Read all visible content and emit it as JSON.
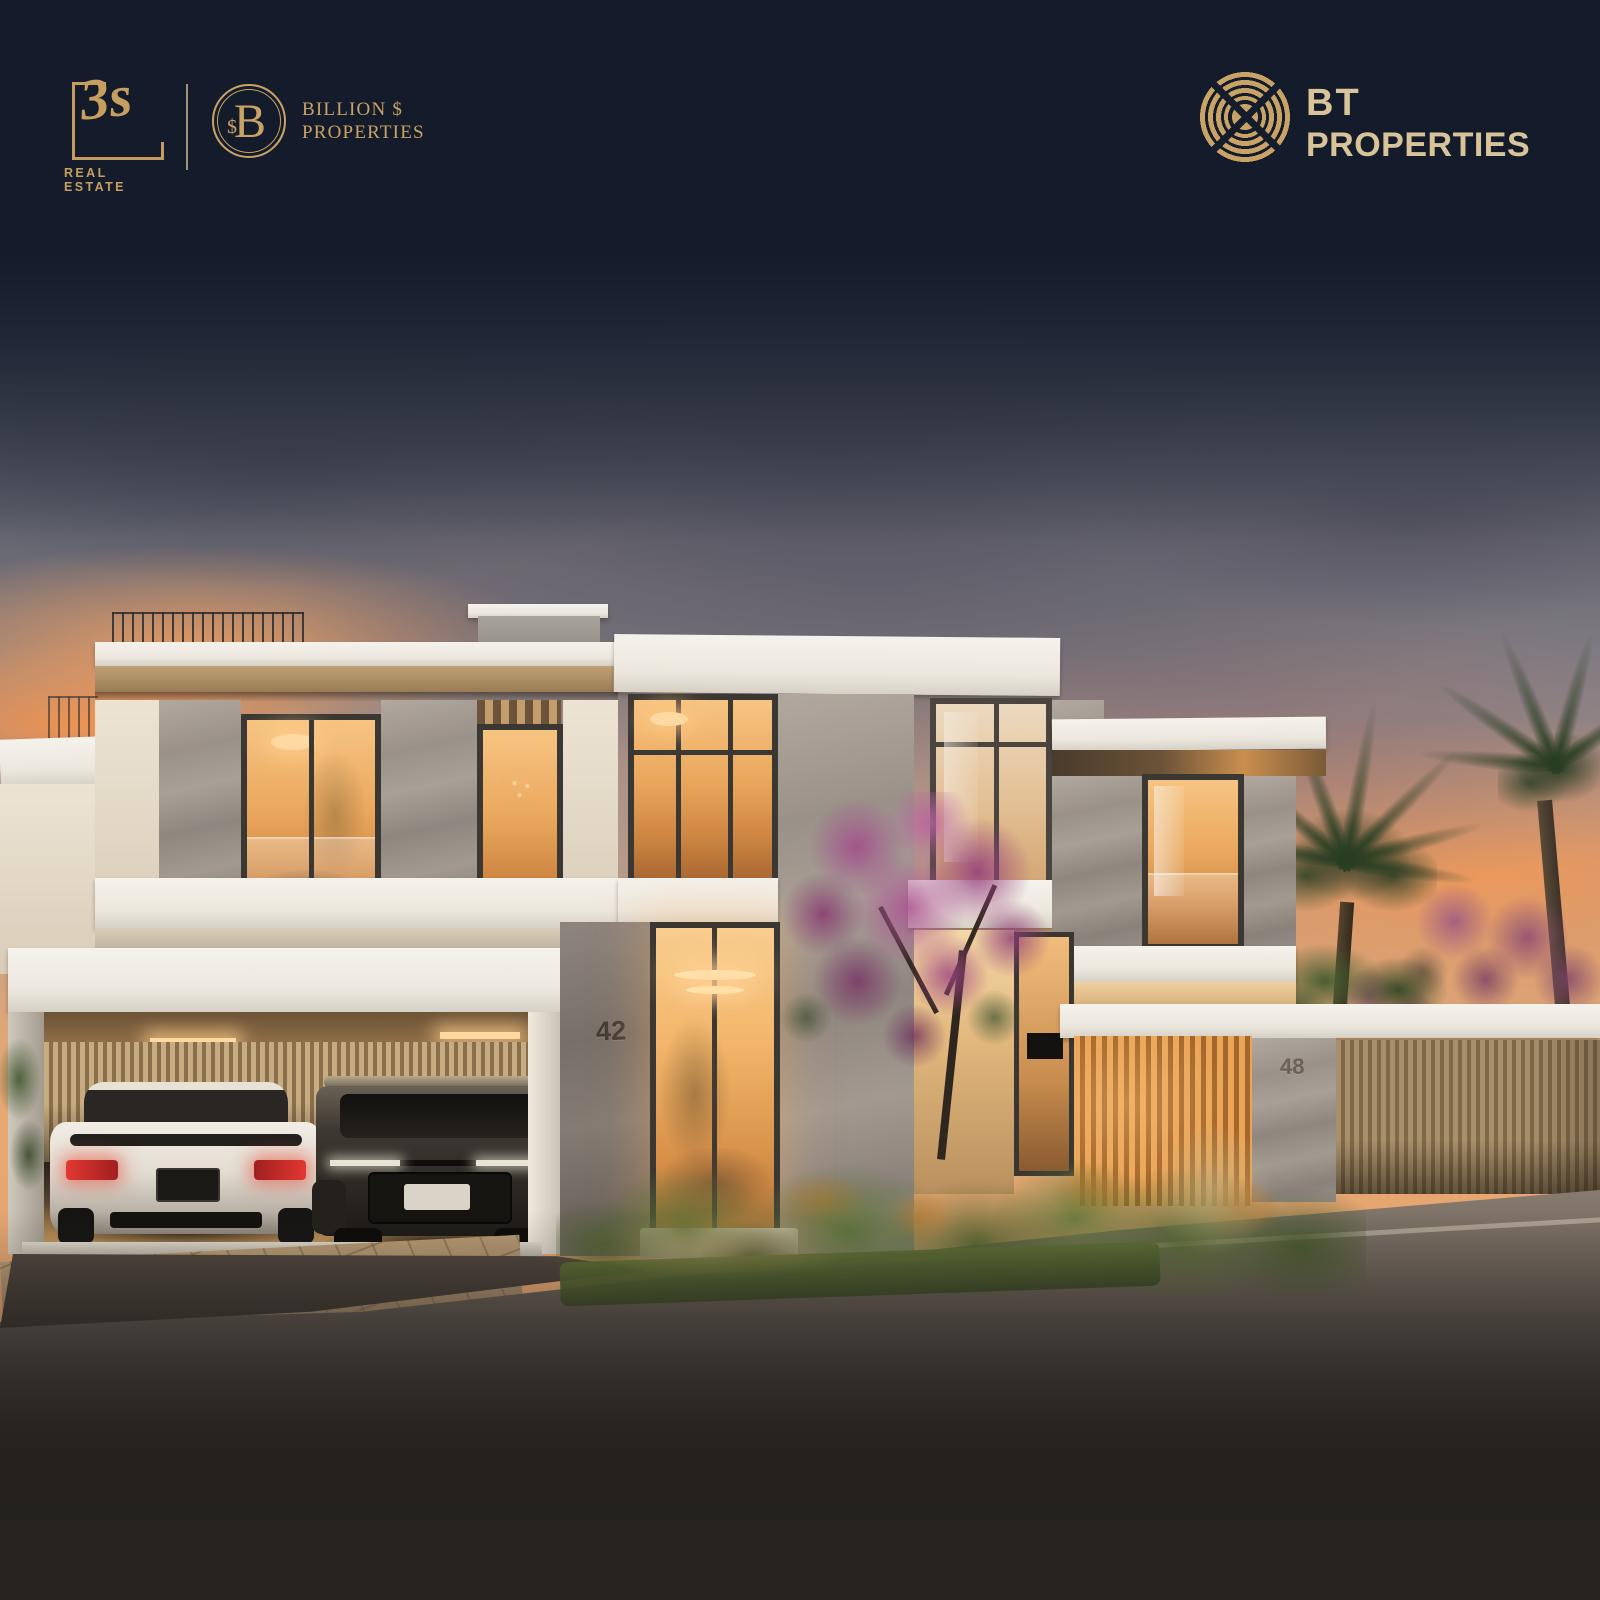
{
  "brand_bar": {
    "agency_3s": {
      "monogram": "3s",
      "caption": "REAL ESTATE"
    },
    "agency_billion": {
      "monogram_letter": "B",
      "monogram_symbol": "$",
      "name_line1": "BILLION $",
      "name_line2": "PROPERTIES"
    },
    "developer_bt": {
      "name_line1": "BT",
      "name_line2": "PROPERTIES"
    }
  },
  "scene": {
    "house_number_front": "42",
    "house_number_side": "48"
  },
  "colors": {
    "brand_gold": "#c9a366",
    "bt_gold": "#d8c498",
    "header_navy": "#151c2b",
    "sunset_orange": "#ef9a5c",
    "window_glow": "#f3ba72",
    "bottom_shadow": "#262321"
  }
}
